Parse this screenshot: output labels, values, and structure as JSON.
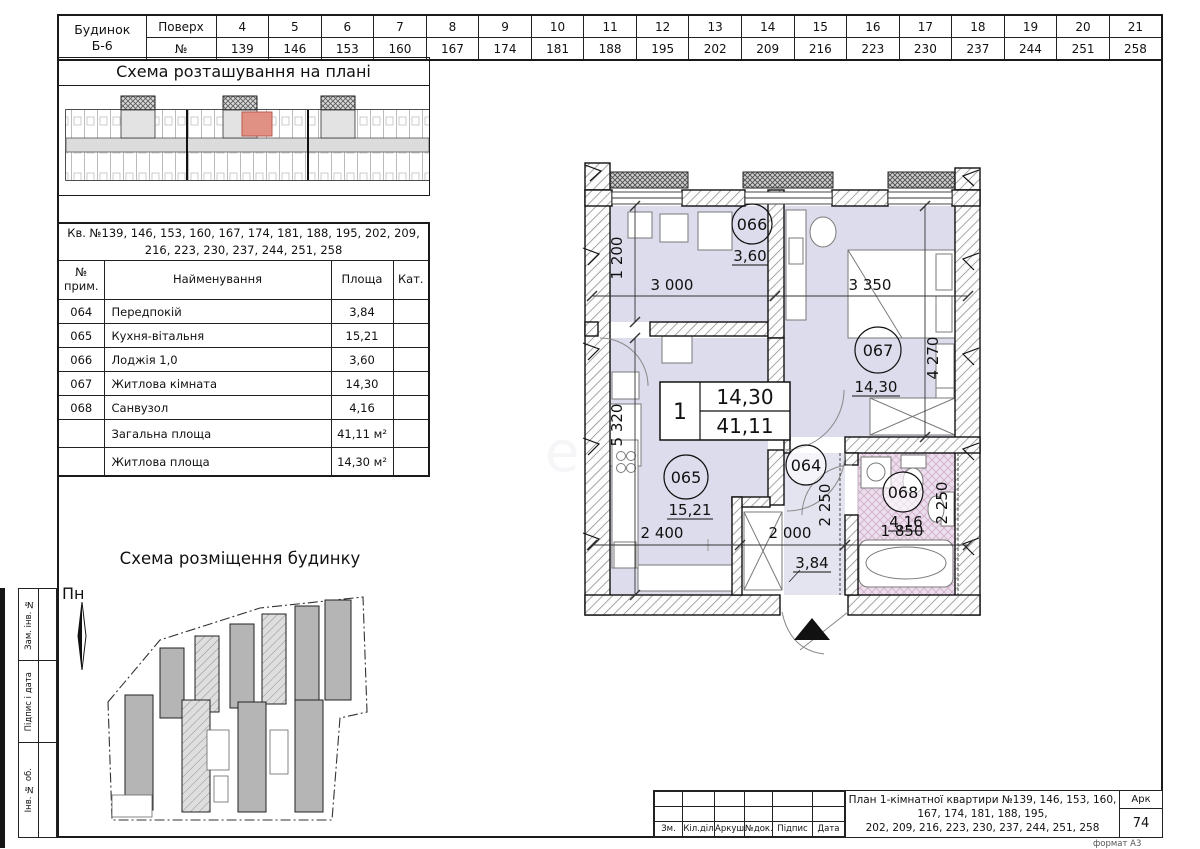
{
  "top_table": {
    "building_line1": "Будинок",
    "building_line2": "Б-6",
    "floor_label": "Поверх",
    "number_label": "№",
    "floors": [
      "4",
      "5",
      "6",
      "7",
      "8",
      "9",
      "10",
      "11",
      "12",
      "13",
      "14",
      "15",
      "16",
      "17",
      "18",
      "19",
      "20",
      "21"
    ],
    "apartments": [
      "139",
      "146",
      "153",
      "160",
      "167",
      "174",
      "181",
      "188",
      "195",
      "202",
      "209",
      "216",
      "223",
      "230",
      "237",
      "244",
      "251",
      "258"
    ]
  },
  "location_scheme": {
    "title": "Схема розташування на плані"
  },
  "area_table": {
    "caption": "Кв. №139, 146, 153, 160, 167, 174, 181, 188, 195, 202, 209, 216, 223, 230, 237, 244, 251, 258",
    "col_num_line1": "№",
    "col_num_line2": "прим.",
    "col_name": "Найменування",
    "col_area": "Площа",
    "col_cat": "Кат.",
    "rows": [
      {
        "num": "064",
        "name": "Передпокій",
        "area": "3,84"
      },
      {
        "num": "065",
        "name": "Кухня-вітальня",
        "area": "15,21"
      },
      {
        "num": "066",
        "name": "Лоджія 1,0",
        "area": "3,60"
      },
      {
        "num": "067",
        "name": "Житлова кімната",
        "area": "14,30"
      },
      {
        "num": "068",
        "name": "Санвузол",
        "area": "4,16"
      }
    ],
    "total_label": "Загальна площа",
    "total_value": "41,11 м²",
    "living_label": "Житлова площа",
    "living_value": "14,30 м²"
  },
  "site_scheme": {
    "title": "Схема розміщення будинку",
    "north": "Пн"
  },
  "plan": {
    "rooms": {
      "r066": {
        "id": "066",
        "area": "3,60"
      },
      "r067": {
        "id": "067",
        "area": "14,30"
      },
      "r065": {
        "id": "065",
        "area": "15,21"
      },
      "r064": {
        "id": "064",
        "area": "3,84"
      },
      "r068": {
        "id": "068",
        "area": "4,16"
      }
    },
    "apt": {
      "number": "1",
      "living": "14,30",
      "total": "41,11"
    },
    "dims": {
      "w_loggia": "3 000",
      "w_bedroom": "3 350",
      "h_loggia": "1 200",
      "h_bedroom": "4 270",
      "h_kitchen": "5 320",
      "w_kitchen": "2 400",
      "w_hall": "2 000",
      "w_bath": "1 850",
      "h_hall": "2 250",
      "h_bath": "2 250"
    }
  },
  "title_block": {
    "cols": [
      "Зм.",
      "Кіл.діл",
      "Аркуш",
      "№док.",
      "Підпис",
      "Дата"
    ],
    "title_line1": "План 1-кімнатної квартири №139, 146, 153, 160, 167, 174, 181, 188, 195,",
    "title_line2": "202, 209, 216, 223, 230, 237, 244, 251, 258",
    "sheet_label": "Арк",
    "sheet_number": "74",
    "format": "формат А3"
  },
  "margins": {
    "m1": "Зам. інв. №",
    "m2": "Підпис і дата",
    "m3": "Інв. № об."
  },
  "watermark": {
    "big": "S",
    "word": "estate"
  }
}
